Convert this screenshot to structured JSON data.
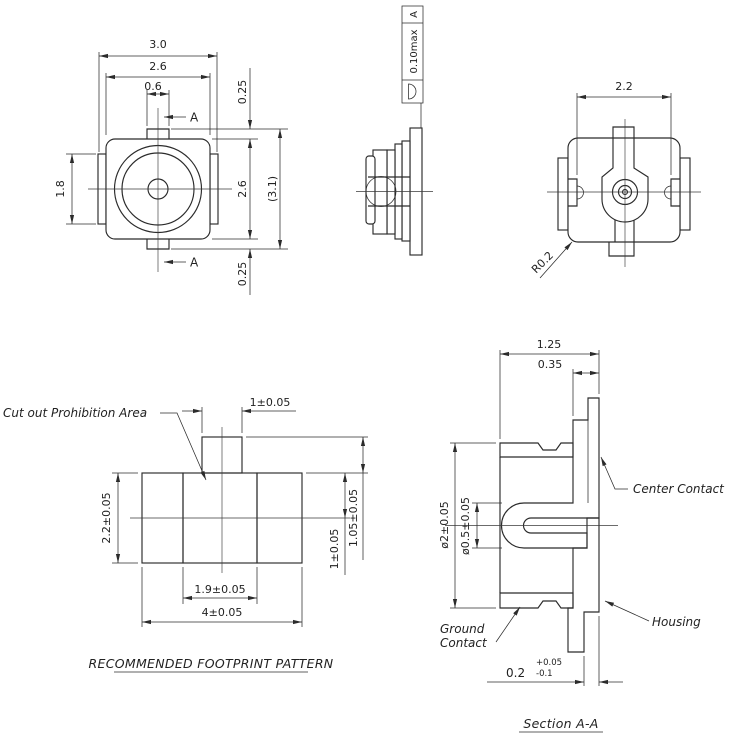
{
  "colors": {
    "line": "#2b2b2b",
    "background": "#ffffff"
  },
  "front": {
    "w_outer": "3.0",
    "w_body": "2.6",
    "w_stem": "0.6",
    "h_flange": "1.8",
    "off_top": "0.25",
    "h_body": "2.6",
    "h_overall": "(3.1)",
    "off_bottom": "0.25",
    "sec_top": "A",
    "sec_bottom": "A"
  },
  "side": {
    "fcf_tol": "0.10max",
    "fcf_datum": "A",
    "fcf_symbol_icon": "profile-of-surface-icon"
  },
  "back": {
    "w_top": "2.2",
    "corner_radius": "R0.2"
  },
  "footprint": {
    "cutout": "Cut out Prohibition Area",
    "pad_w": "1±0.05",
    "h": "2.2±0.05",
    "pad_h": "1.05±0.05",
    "half_h": "1±0.05",
    "gap": "1.9±0.05",
    "w": "4±0.05",
    "title": "RECOMMENDED FOOTPRINT PATTERN"
  },
  "section": {
    "w": "1.25",
    "lead_w": "0.35",
    "dia_outer": "ø2±0.05",
    "dia_bore": "ø0.5±0.05",
    "gap": "0.2",
    "gap_tol_plus": "+0.05",
    "gap_tol_minus": "-0.1",
    "center_contact": "Center Contact",
    "housing": "Housing",
    "ground1": "Ground",
    "ground2": "Contact",
    "title": "Section A-A"
  }
}
